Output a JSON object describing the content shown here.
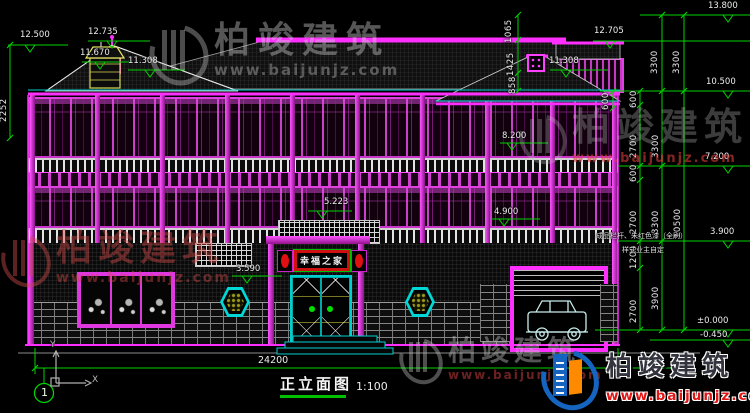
{
  "drawing": {
    "title": "正立面图",
    "scale": "1:100",
    "overall_width_dim": "24200",
    "axis_bubble": "1",
    "ucs_x": "X",
    "ucs_y": "Y",
    "plaque_text": "幸福之家",
    "note_line1": "成品栏杆、朱红色漆（全刷）",
    "note_line2": "样式业主自定"
  },
  "elevations": {
    "top_left": "12.500",
    "ridge_left": "12.735",
    "left_gable_upper": "11.670",
    "left_gable_lower": "11.308",
    "roof_top": "13.800",
    "right_ridge": "12.705",
    "right_gable": "11.308",
    "right_eave": "10.500",
    "floor3_window": "8.200",
    "floor3": "7.200",
    "balcony": "5.223",
    "floor2_window": "4.900",
    "floor2": "3.900",
    "porch": "3.590",
    "ground": "±0.000",
    "plinth": "-0.450"
  },
  "dims": {
    "left_height": "2252",
    "gable_a": "1065",
    "gable_b": "1425",
    "gable_c": "858",
    "eave_600": "600",
    "chain_600_top": "600",
    "upper_3300_a": "3300",
    "upper_3300_b": "3300",
    "fl3_600": "600",
    "fl3_2700": "2700",
    "fl2_600": "600",
    "fl2_2700": "2700",
    "fl1_1200": "1200",
    "fl1_2700": "2700",
    "mid_3300_a": "3300",
    "mid_3300_b": "3300",
    "mid_3900": "3900",
    "total_10500": "10500"
  },
  "watermarks": {
    "brand": "柏竣建筑",
    "url": "www.baijunjz.com"
  },
  "colors": {
    "dim_green": "#00d200",
    "line_magenta": "#ff30ff",
    "line_cyan": "#00e0e0",
    "accent_red": "#e01515",
    "logo_blue": "#1565c0",
    "logo_orange": "#ff8a00"
  }
}
